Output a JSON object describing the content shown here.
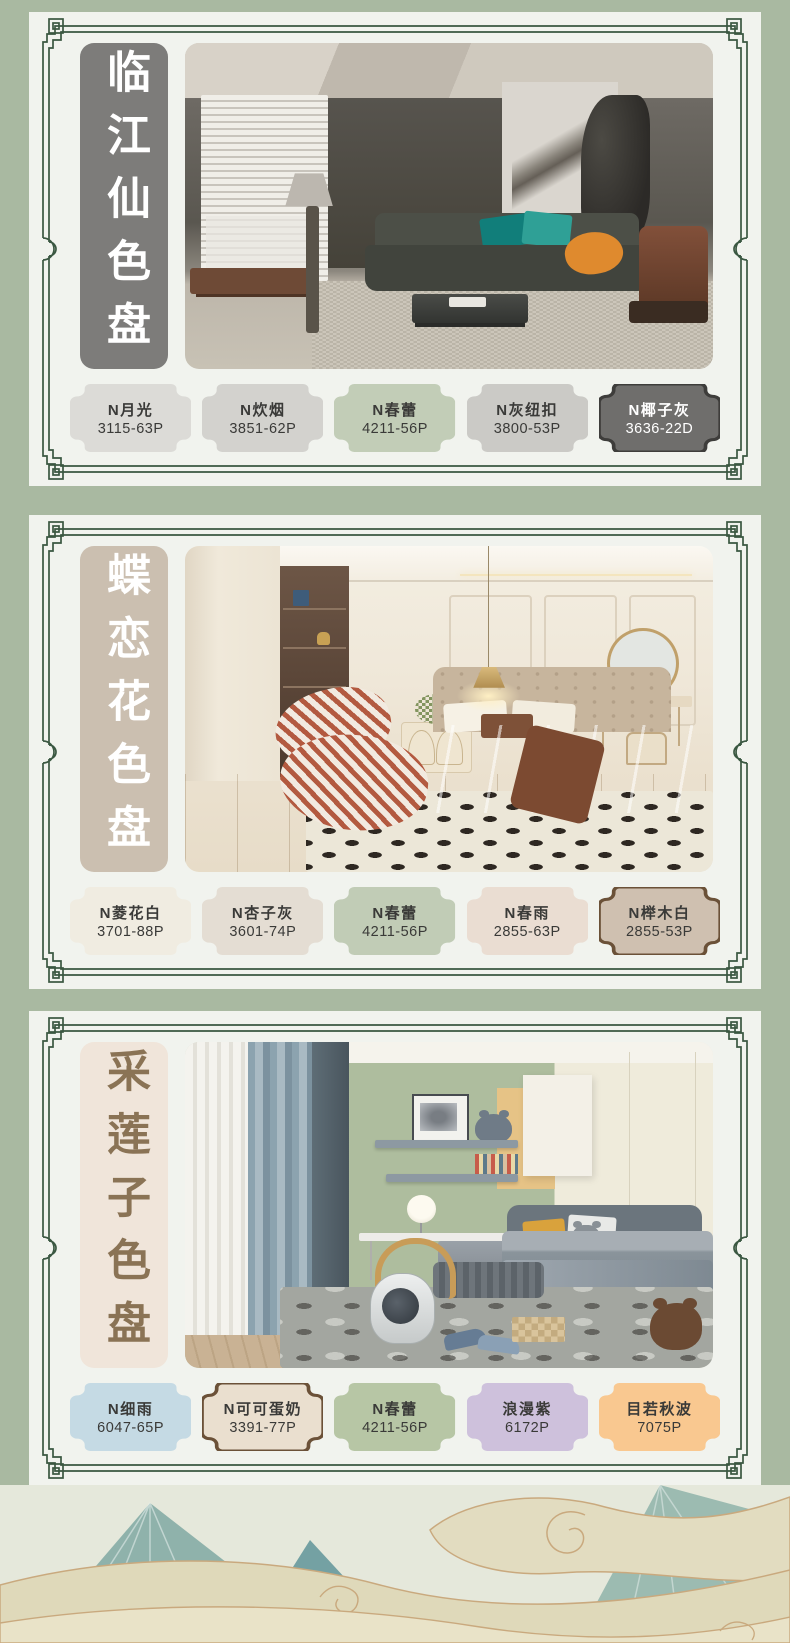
{
  "page": {
    "background_color": "#A9B9A1",
    "card_background": "#F1F3EE",
    "frame_color": "#3A5741",
    "disclaimer": "*关于色差：因受显示设备的影响，颜色可能会出现色差，请以实际色卡的颜色为准。"
  },
  "decor": {
    "wave_teal_light": "#9CBBB1",
    "wave_teal": "#8FB2AB",
    "wave_teal_dark": "#74A1A3",
    "wave_cream": "#DFD9BA",
    "wave_outline": "#C9A97E"
  },
  "sections": [
    {
      "title": "临江仙色盘",
      "title_bg": "#7D7C7A",
      "title_color": "#FFFFFF",
      "swatches": [
        {
          "name": "N月光",
          "code": "3115-63P",
          "color": "#DCDBD7",
          "text": "#3A3A38"
        },
        {
          "name": "N炊烟",
          "code": "3851-62P",
          "color": "#D3D2CE",
          "text": "#3A3A38"
        },
        {
          "name": "N春蕾",
          "code": "4211-56P",
          "color": "#C2CDB7",
          "text": "#3A3A38"
        },
        {
          "name": "N灰纽扣",
          "code": "3800-53P",
          "color": "#CBCAC6",
          "text": "#3A3A38"
        },
        {
          "name": "N椰子灰",
          "code": "3636-22D",
          "color": "#6F6E6C",
          "text": "#FFFFFF",
          "border": "#3E3D3B"
        }
      ]
    },
    {
      "title": "蝶恋花色盘",
      "title_bg": "#CBBFB0",
      "title_color": "#FFFFFF",
      "swatches": [
        {
          "name": "N菱花白",
          "code": "3701-88P",
          "color": "#F0ECE1",
          "text": "#3A3A38"
        },
        {
          "name": "N杏子灰",
          "code": "3601-74P",
          "color": "#E4DDD3",
          "text": "#3A3A38"
        },
        {
          "name": "N春蕾",
          "code": "4211-56P",
          "color": "#C1CCB6",
          "text": "#3A3A38"
        },
        {
          "name": "N春雨",
          "code": "2855-63P",
          "color": "#EADDD2",
          "text": "#3A3A38"
        },
        {
          "name": "N榉木白",
          "code": "2855-53P",
          "color": "#CFC0B0",
          "text": "#3A3A38",
          "border": "#6B5138"
        }
      ]
    },
    {
      "title": "采莲子色盘",
      "title_bg": "#F0E5DA",
      "title_color": "#8A7355",
      "swatches": [
        {
          "name": "N细雨",
          "code": "6047-65P",
          "color": "#C5DAE4",
          "text": "#3A3A38"
        },
        {
          "name": "N可可蛋奶",
          "code": "3391-77P",
          "color": "#EADFCF",
          "text": "#3A3A38",
          "border": "#6B5138"
        },
        {
          "name": "N春蕾",
          "code": "4211-56P",
          "color": "#B7C6A5",
          "text": "#3A3A38"
        },
        {
          "name": "浪漫紫",
          "code": "6172P",
          "color": "#CEC1DC",
          "text": "#3A3A38"
        },
        {
          "name": "目若秋波",
          "code": "7075P",
          "color": "#F9C890",
          "text": "#3A3A38"
        }
      ]
    }
  ]
}
